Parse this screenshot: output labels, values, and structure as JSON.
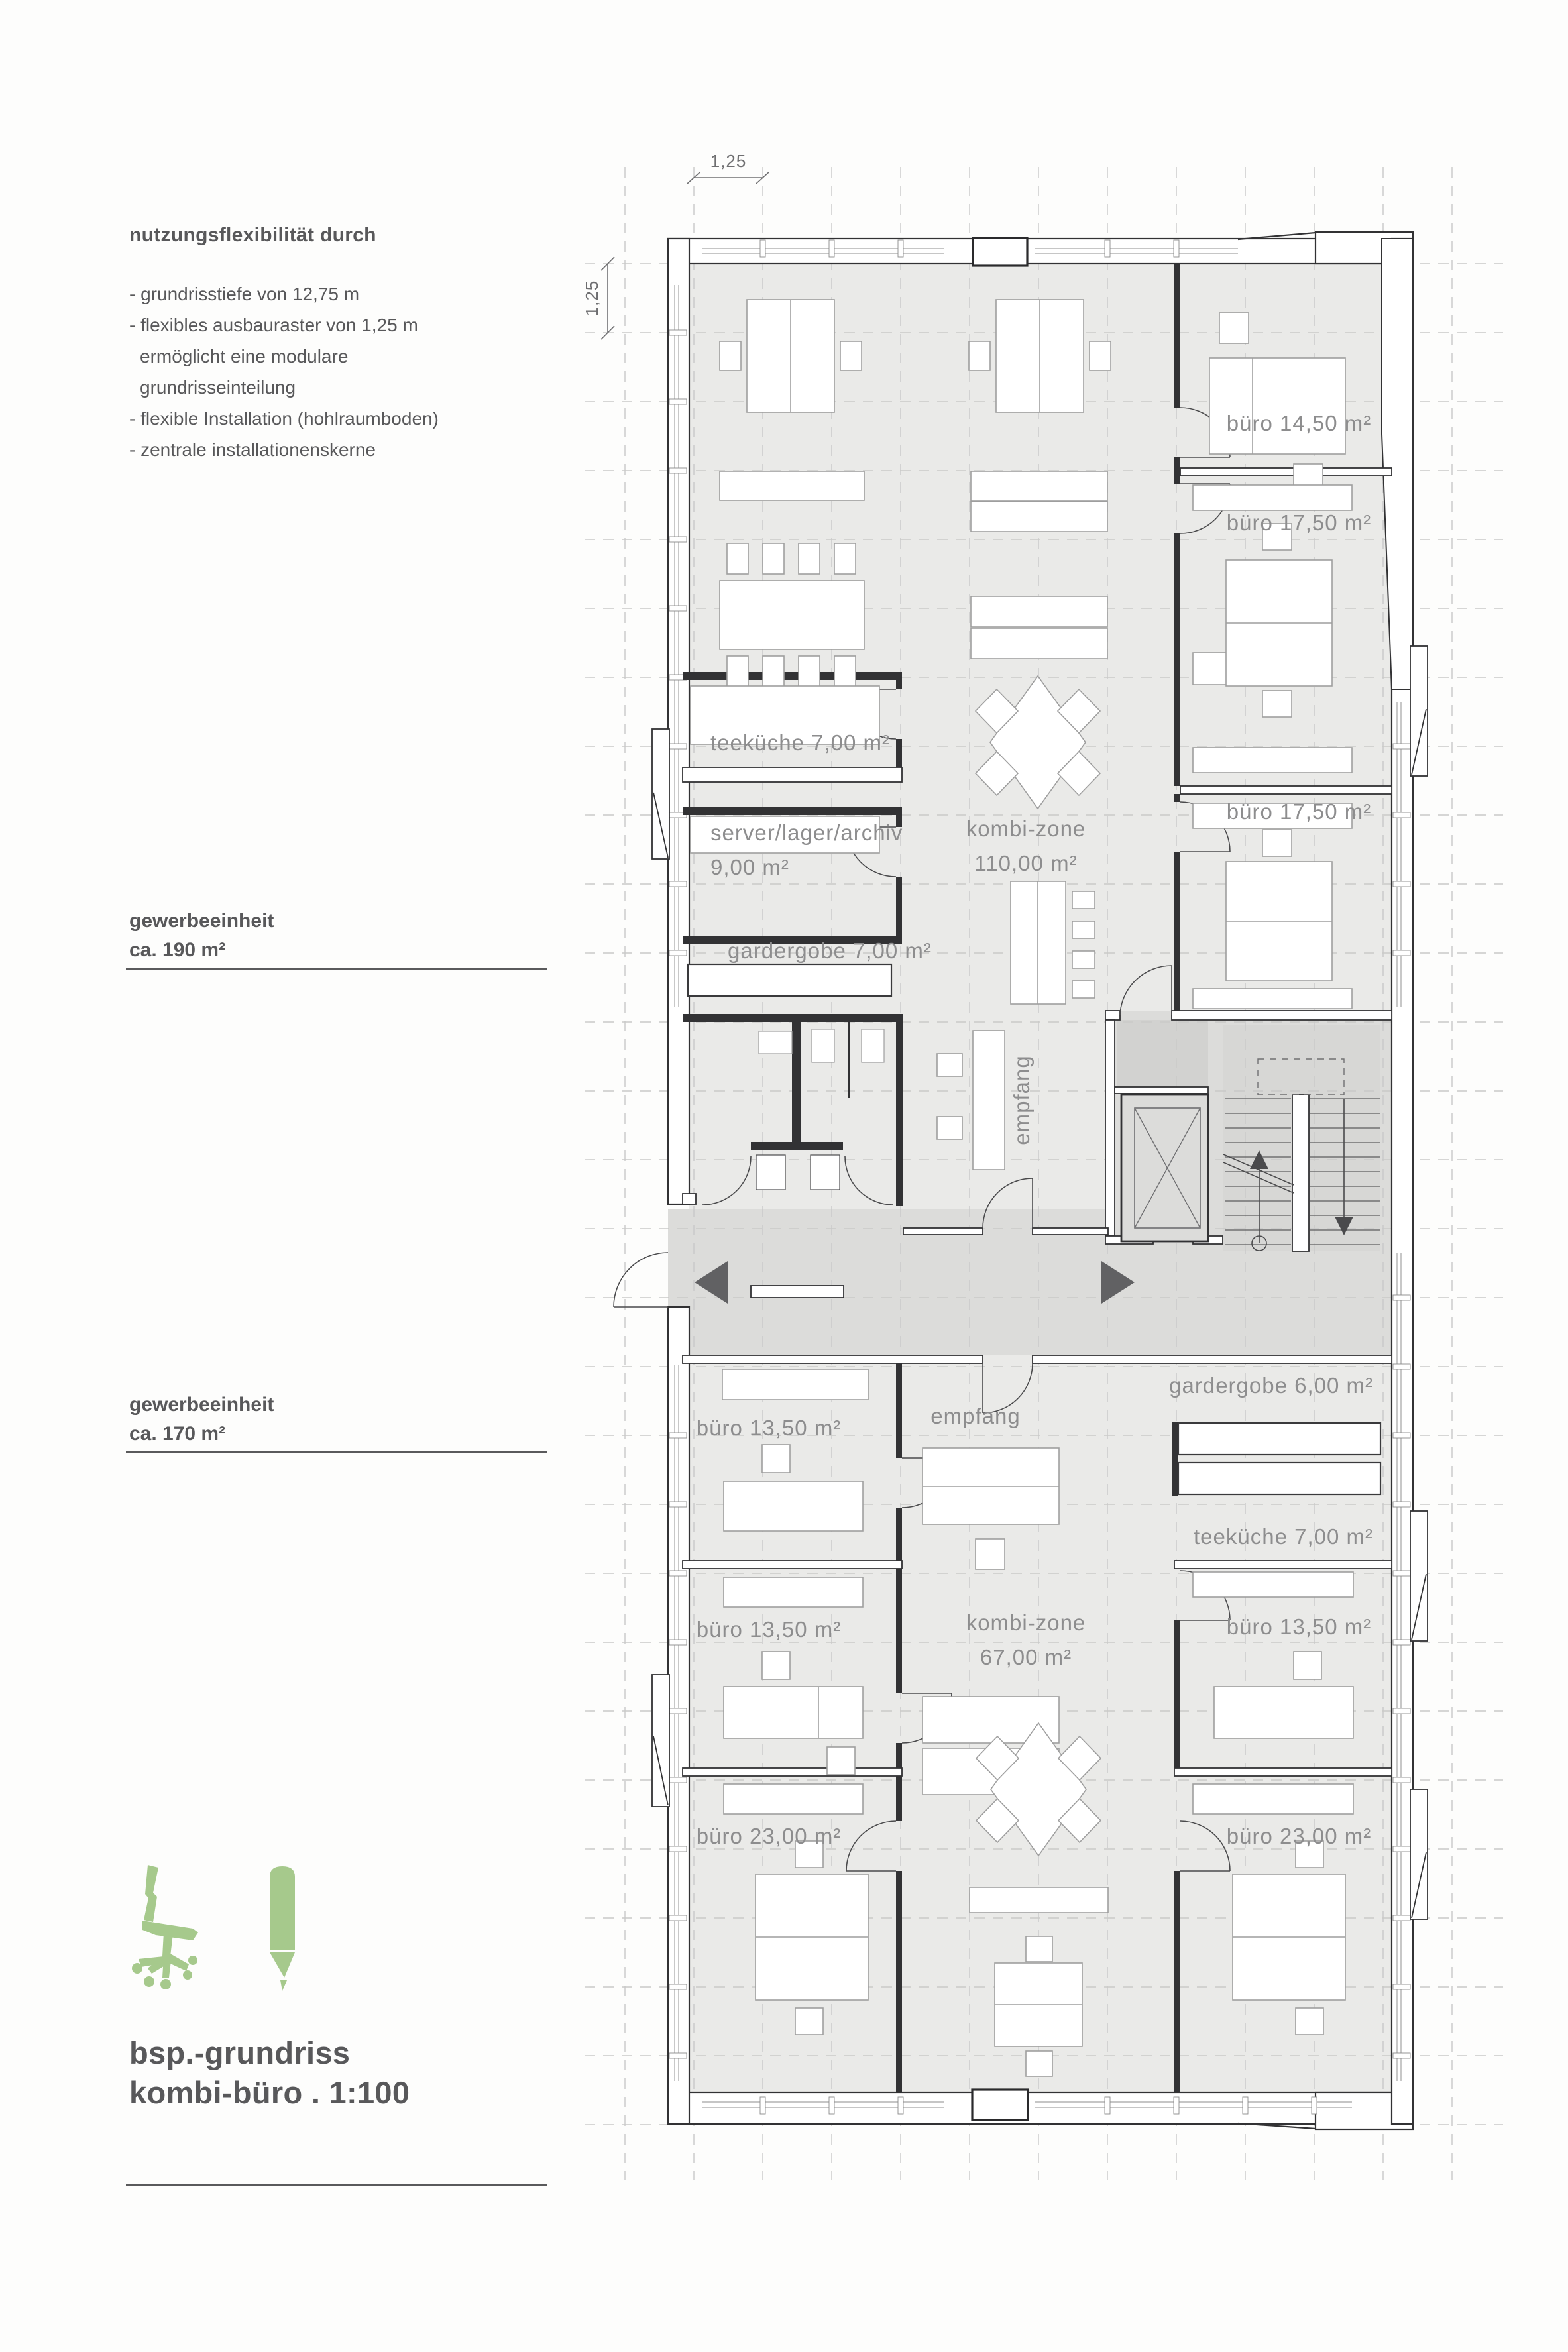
{
  "sidebar": {
    "heading": "nutzungsflexibilität durch",
    "bullets": [
      "- grundrisstiefe von 12,75 m",
      "- flexibles ausbauraster von 1,25 m",
      "ermöglicht eine modulare",
      "grundrisseinteilung",
      "- flexible Installation (hohlraumboden)",
      "- zentrale installationenskerne"
    ],
    "unit_upper": {
      "name": "gewerbeeinheit",
      "area": "ca. 190 m²"
    },
    "unit_lower": {
      "name": "gewerbeeinheit",
      "area": "ca. 170 m²"
    },
    "title": {
      "line1": "bsp.-grundriss",
      "line2": "kombi-büro . 1:100"
    }
  },
  "dimensions": {
    "top": "1,25",
    "left": "1,25"
  },
  "plan": {
    "rooms": {
      "buero_1450": "büro 14,50 m²",
      "buero_1750_a": "büro 17,50 m²",
      "buero_1750_b": "büro 17,50 m²",
      "teekueche_upper": "teeküche 7,00 m²",
      "kombi_upper_name": "kombi-zone",
      "kombi_upper_area": "110,00 m²",
      "server_name": "server/lager/archiv",
      "server_area": "9,00 m²",
      "garderobe_upper": "gardergobe 7,00 m²",
      "empfang_upper": "empfang",
      "garderobe_lower": "gardergobe 6,00 m²",
      "empfang_lower": "empfang",
      "teekueche_lower": "teeküche 7,00 m²",
      "kombi_lower_name": "kombi-zone",
      "kombi_lower_area": "67,00 m²",
      "buero_1350_left_1": "büro 13,50 m²",
      "buero_1350_left_2": "büro 13,50 m²",
      "buero_1350_right": "büro 13,50 m²",
      "buero_2300_left": "büro 23,00 m²",
      "buero_2300_right": "büro 23,00 m²"
    }
  },
  "colors": {
    "accent_green": "#a6c98c",
    "floor": "#eaeae8",
    "circulation": "#dcdcda",
    "wall": "#323234",
    "label": "#8d8d8e",
    "text": "#58585a"
  }
}
